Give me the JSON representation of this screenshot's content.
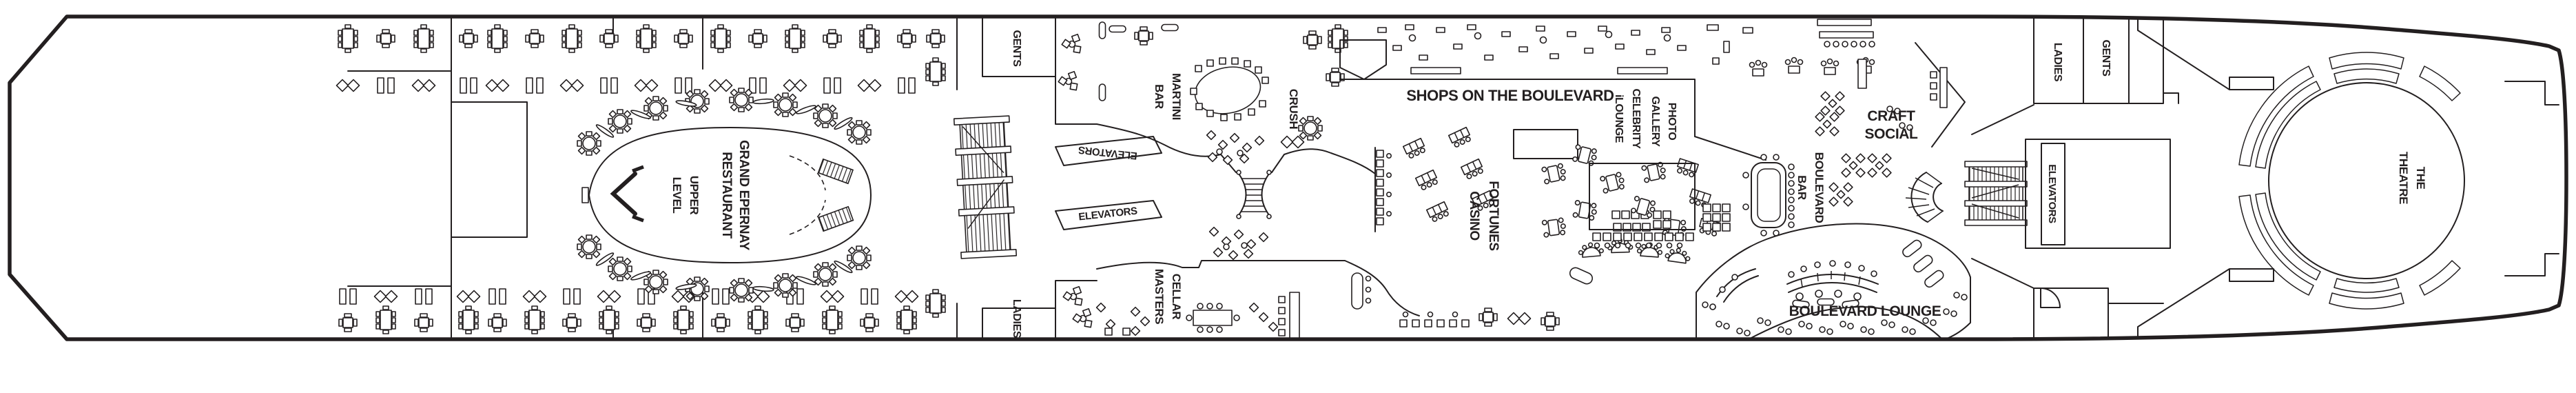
{
  "deck": {
    "colors": {
      "ink": "#231f20",
      "paper": "#ffffff"
    },
    "venues": {
      "grand_epernay": {
        "line1": "GRAND EPERNAY",
        "line2": "RESTAURANT"
      },
      "upper_level": {
        "line1": "UPPER",
        "line2": "LEVEL"
      },
      "gents_aft": {
        "label": "GENTS"
      },
      "ladies_aft": {
        "label": "LADIES"
      },
      "elevators_aft_port": {
        "label": "ELEVATORS"
      },
      "elevators_aft_stbd": {
        "label": "ELEVATORS"
      },
      "martini_bar": {
        "line1": "MARTINI",
        "line2": "BAR"
      },
      "crush": {
        "label": "CRUSH"
      },
      "cellar_masters": {
        "line1": "CELLAR",
        "line2": "MASTERS"
      },
      "shops_on_the_boulevard": {
        "label": "SHOPS ON THE BOULEVARD"
      },
      "fortunes_casino": {
        "line1": "FORTUNES",
        "line2": "CASINO"
      },
      "photo_gallery": {
        "line1": "PHOTO",
        "line2": "GALLERY"
      },
      "celebrity_ilounge": {
        "line1": "CELEBRITY",
        "line2": "iLOUNGE"
      },
      "craft_social": {
        "line1": "CRAFT",
        "line2": "SOCIAL"
      },
      "boulevard_bar": {
        "line1": "BOULEVARD",
        "line2": "BAR"
      },
      "boulevard_lounge": {
        "label": "BOULEVARD LOUNGE"
      },
      "ladies_fwd": {
        "label": "LADIES"
      },
      "gents_fwd": {
        "label": "GENTS"
      },
      "elevators_fwd": {
        "label": "ELEVATORS"
      },
      "the_theatre": {
        "line1": "THE",
        "line2": "THEATRE"
      }
    }
  }
}
